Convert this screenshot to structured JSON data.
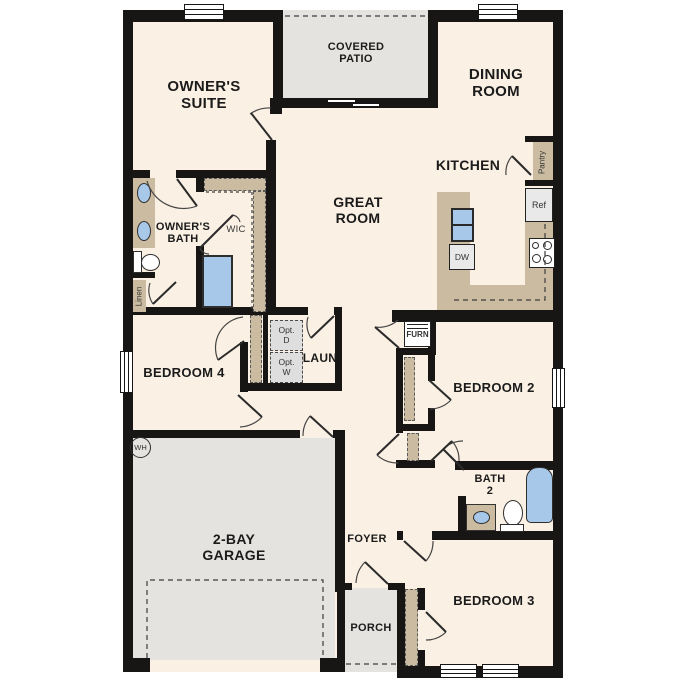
{
  "colors": {
    "floor": "#faf0e3",
    "outdoor": "#e4e3e0",
    "casework": "#cbbca1",
    "fixture": "#a8c8e9",
    "wall": "#171615",
    "text": "#1b1b1b"
  },
  "rooms": {
    "owners_suite": [
      "OWNER'S",
      "SUITE"
    ],
    "covered_patio": [
      "COVERED",
      "PATIO"
    ],
    "dining_room": [
      "DINING",
      "ROOM"
    ],
    "kitchen": "KITCHEN",
    "great_room": [
      "GREAT",
      "ROOM"
    ],
    "owners_bath": [
      "OWNER'S",
      "BATH"
    ],
    "wic": "WIC",
    "laundry": "LAUN",
    "bedroom4": "BEDROOM 4",
    "bedroom2": "BEDROOM 2",
    "bath2": [
      "BATH",
      "2"
    ],
    "garage": [
      "2-BAY",
      "GARAGE"
    ],
    "foyer": "FOYER",
    "porch": "PORCH",
    "bedroom3": "BEDROOM 3"
  },
  "features": {
    "pantry": "Pantry",
    "ref": "Ref",
    "dw": "DW",
    "linen": "Linen",
    "furn": "FURN",
    "wh": "WH",
    "opt_dryer": [
      "Opt.",
      "D"
    ],
    "opt_washer": [
      "Opt.",
      "W"
    ]
  }
}
